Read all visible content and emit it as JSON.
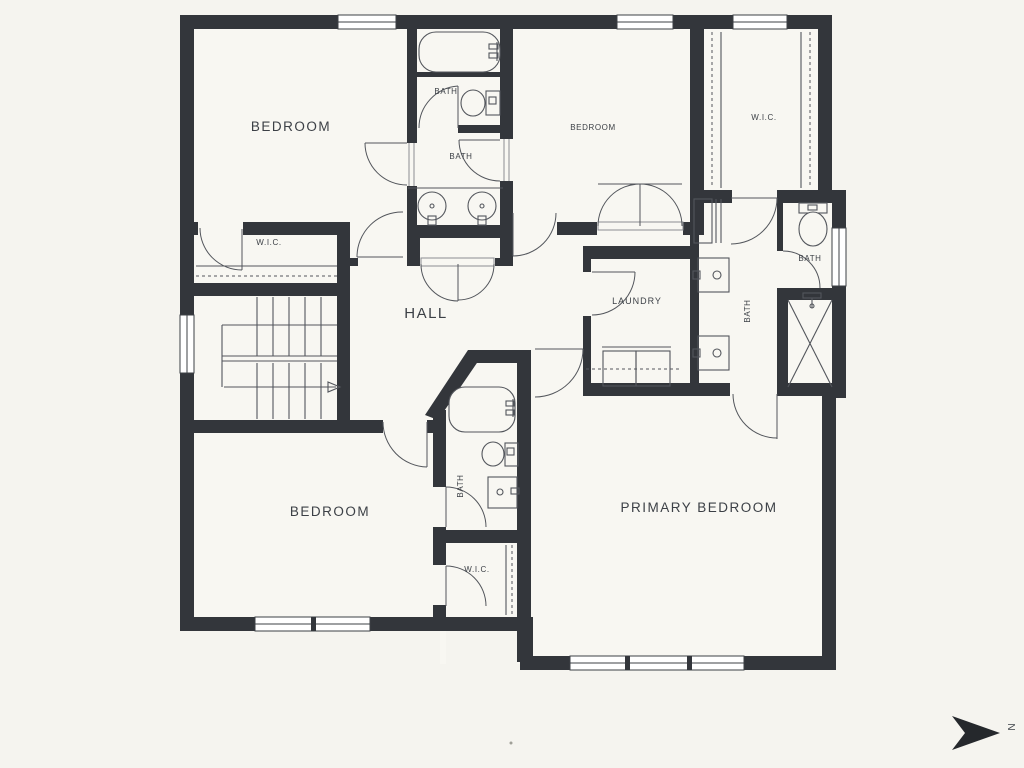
{
  "title": "Second floor plan",
  "colors": {
    "background": "#f5f4ef",
    "room": "#f8f7f2",
    "wall": "#33363b",
    "line": "#53565c",
    "text": "#3c4046"
  },
  "labels": {
    "bedroom_top_left": "BEDROOM",
    "bedroom_top_right": "BEDROOM",
    "bedroom_bottom_left": "BEDROOM",
    "primary_bedroom": "PRIMARY BEDROOM",
    "hall": "HALL",
    "laundry": "LAUNDRY",
    "wic_left": "W.I.C.",
    "wic_top_right": "W.I.C.",
    "wic_bottom_center": "W.I.C.",
    "bath_top_inner": "BATH",
    "bath_top_shared": "BATH",
    "bath_primary": "BATH",
    "bath_primary_toilet": "BATH",
    "bath_center": "BATH",
    "compass_north": "N"
  }
}
